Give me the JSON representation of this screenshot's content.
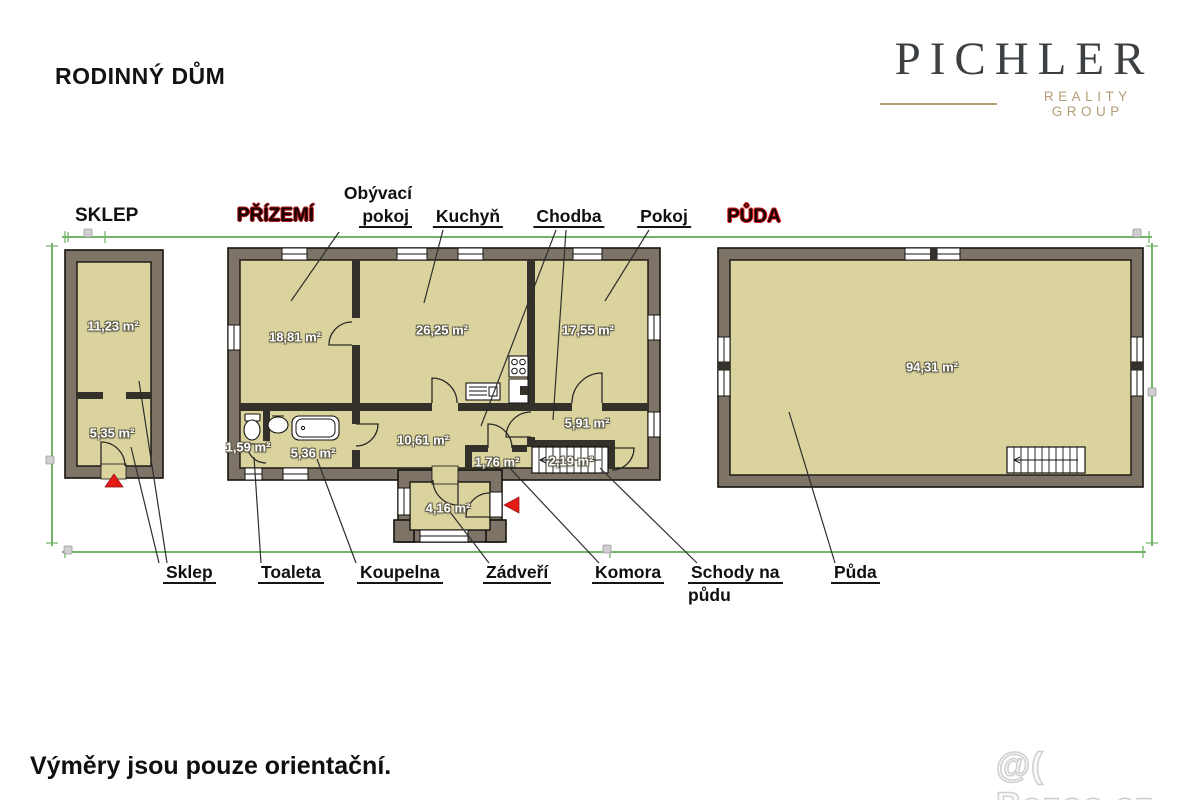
{
  "page": {
    "title": "RODINNÝ DŮM",
    "footer_note": "Výměry jsou pouze orientační.",
    "watermark": "@( Bazos.cz"
  },
  "logo": {
    "brand": "PICHLER",
    "tagline": "REALITY GROUP"
  },
  "floor_titles": {
    "sklep": "SKLEP",
    "prizemi": "PŘÍZEMÍ",
    "puda": "PŮDA"
  },
  "room_labels": {
    "obyvaci_line1": "Obývací",
    "obyvaci_line2": "pokoj",
    "kuchyn": "Kuchyň",
    "chodba": "Chodba",
    "pokoj": "Pokoj",
    "sklep": "Sklep",
    "toaleta": "Toaleta",
    "koupelna": "Koupelna",
    "zadveri": "Zádveří",
    "komora": "Komora",
    "schody_line1": "Schody na",
    "schody_line2": "půdu",
    "puda": "Půda"
  },
  "areas": {
    "sklep_upper": "11,23 m²",
    "sklep_lower": "5,35 m²",
    "obyvaci": "18,81 m²",
    "kuchyn": "26,25 m²",
    "pokoj": "17,55 m²",
    "chodba_main": "10,61 m²",
    "chodba_upper": "5,91 m²",
    "toaleta": "1,59 m²",
    "koupelna": "5,36 m²",
    "komora": "1,76 m²",
    "schody": "2,19 m²",
    "zadveri": "4,16 m²",
    "puda": "94,31 m²"
  },
  "colors": {
    "wall": "#7d7467",
    "room_fill": "#dbd39e",
    "dimension_line": "#74b46a",
    "floor_accent_dark_red": "#b01c1c",
    "floor_accent_red": "#e01818",
    "entrance_arrow": "#e41b17",
    "logo_text": "#3d4043",
    "logo_gold": "#b39c76"
  }
}
